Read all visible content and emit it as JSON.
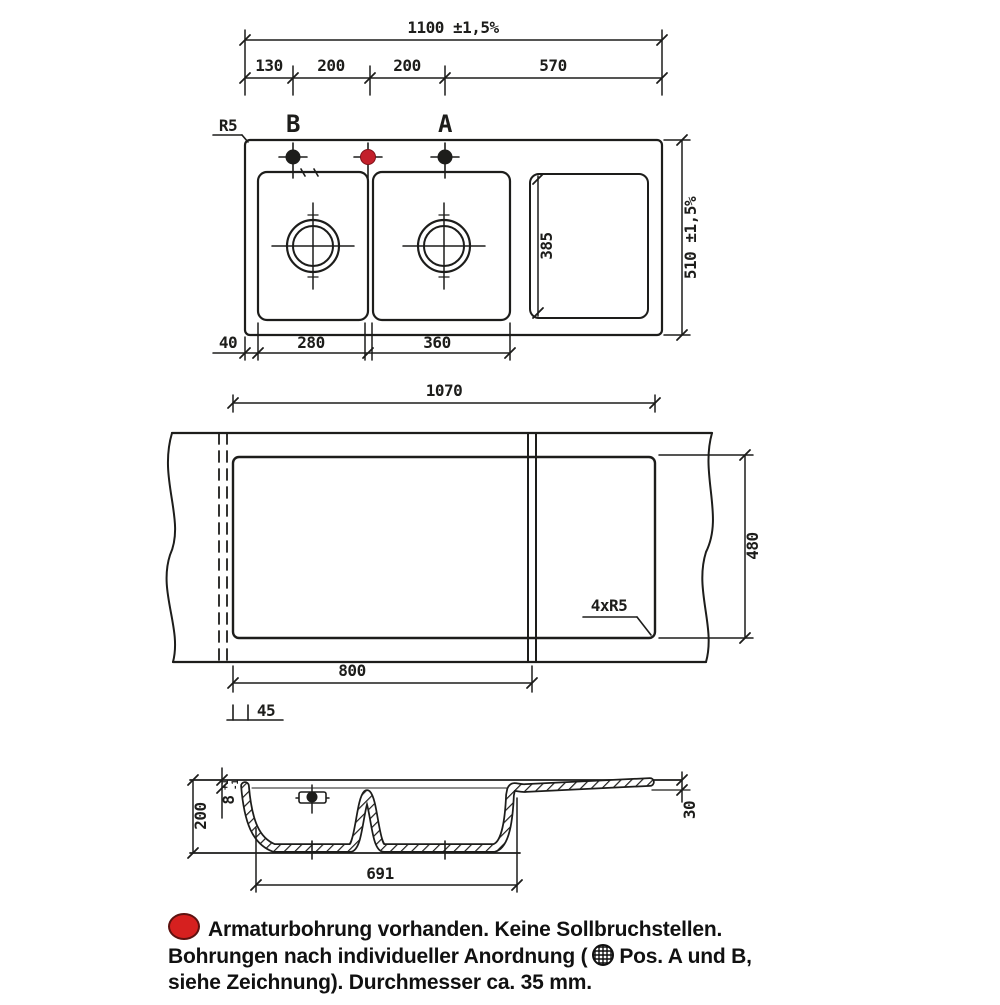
{
  "drawing_type": "sink technical drawing (plan view, worktop cut-out, cross-section)",
  "colors": {
    "line": "#1d1d1b",
    "red_hole": "#c3202b",
    "red_dot": "#d6201f",
    "background": "#ffffff"
  },
  "icons": {
    "red_dot": "red-filled-circle",
    "hole_symbol": "hatched-circle",
    "tap_holes": "crosshair-filled-circle"
  },
  "top_view": {
    "dim_total_width": "1100 ±1,5%",
    "segments": [
      "130",
      "200",
      "200",
      "570"
    ],
    "label_radius": "R5",
    "label_hole_b": "B",
    "label_hole_a": "A",
    "dim_total_height": "510 ±1,5%",
    "dim_drainer_height": "385",
    "dim_edge": "40",
    "dim_bowl1": "280",
    "dim_bowl2": "360"
  },
  "cutout_view": {
    "dim_width": "1070",
    "dim_height": "480",
    "label_corner_radius": "4xR5",
    "dim_bowl_zone": "800",
    "dim_offset": "45"
  },
  "section_view": {
    "dim_depth": "200",
    "dim_rim": "8",
    "dim_rim_tol_plus": "+1",
    "dim_rim_tol_minus": "-1",
    "dim_bowls_width": "691",
    "dim_drainer_edge": "30"
  },
  "footer": {
    "line1": "Armaturbohrung vorhanden. Keine Sollbruchstellen.",
    "line2_pre": "Bohrungen nach individueller Anordnung (",
    "line2_post": "Pos. A und B,",
    "line3": "siehe Zeichnung). Durchmesser ca. 35 mm."
  }
}
